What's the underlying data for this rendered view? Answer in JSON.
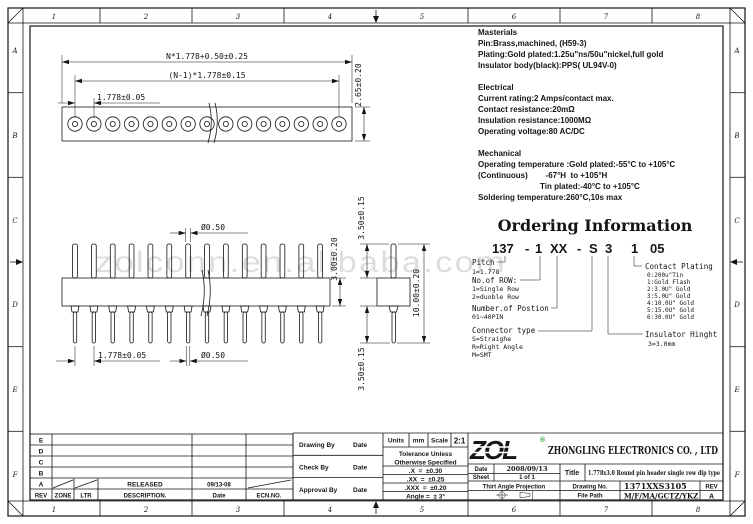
{
  "zones": {
    "cols": [
      "1",
      "2",
      "3",
      "4",
      "5",
      "6",
      "7",
      "8"
    ],
    "rows": [
      "A",
      "B",
      "C",
      "D",
      "E",
      "F"
    ]
  },
  "watermark": "zolconn.en.alibaba.com",
  "dims": {
    "top_overall": "N*1.778+0.50±0.25",
    "top_centers": "(N-1)*1.778±0.15",
    "top_pitch": "1.778±0.05",
    "top_height": "2.65±0.20",
    "pin_dia_top": "Ø0.50",
    "front_pitch": "1.778±0.05",
    "pin_dia_bottom": "Ø0.50",
    "body_height": "3.00±0.20",
    "side_top_pin": "3.50±0.15",
    "side_overall": "10.00±0.20",
    "side_bottom_pin": "3.50±0.15"
  },
  "specs": {
    "materials": {
      "title": "Masterials",
      "lines": [
        "Pin:Brass,machined, (H59-3)",
        "Plating:Gold plated:1.25u\"ns/50u\"nickel,full gold",
        "Insulator body(black):PPS( UL94V-0)"
      ]
    },
    "electrical": {
      "title": "Electrical",
      "lines": [
        "Current rating:2 Amps/contact max.",
        "Contact resistance:20mΩ",
        "Insulation resistance:1000MΩ",
        "Operating voltage:80 AC/DC"
      ]
    },
    "mechanical": {
      "title": "Mechanical",
      "lines": [
        "Operating temperature :Gold plated:-55°C to +105°C",
        "(Continuous)        -67°H  to +105°H",
        "Tin plated:-40°C to +105°C",
        "Soldering temperature:260°C,10s max"
      ]
    }
  },
  "ordering": {
    "title": "Ordering Information",
    "part_segments": [
      "137",
      "-",
      "1",
      "XX",
      "-",
      "S",
      "3",
      "1",
      "05"
    ],
    "pitch_label": "Pitch",
    "pitch_value": "1=1.778",
    "row_label": "No.of ROW:",
    "row_values": [
      "1=Single Row",
      "2=duoble Row"
    ],
    "position_label": "Number.of Postion",
    "position_value": "01~40PIN",
    "type_label": "Connector type",
    "type_values": [
      "S=Straighe",
      "R=Right Angle",
      "M=SMT"
    ],
    "plating_label": "Contact Plating",
    "plating_values": [
      "0:200u\"Tin",
      "1:Gold Flash",
      "2:3.0U\" Gold",
      "3:5.0U\" Gold",
      "4:10.0U\" Gold",
      "5:15.0U\" Gold",
      "6:30.0U\" Gold"
    ],
    "insulator_label": "Insulator Hinght",
    "insulator_value": "3=3.0mm"
  },
  "title_block": {
    "revision": {
      "headers": [
        "REV",
        "ZONE",
        "LTR",
        "DESCRIPTION.",
        "Date",
        "ECN.NO."
      ],
      "rows": [
        "E",
        "D",
        "C",
        "B",
        "A"
      ],
      "released": "RELEASED",
      "released_date": "09/13-08"
    },
    "sign": {
      "drawing_by": "Drawing By",
      "check_by": "Check By",
      "approval_by": "Approval By",
      "date": "Date"
    },
    "units": {
      "units_label": "Units",
      "units_value": "mm",
      "scale_label": "Scale",
      "scale_value": "2:1",
      "tol_line1": "Tolerance Unless",
      "tol_line2": "Otherwise Specified",
      "tols": [
        ".X  =  ±0.30",
        ".XX  =  ±0.25",
        ".XXX  =  ±0.20",
        "Angle =  ± 3°"
      ]
    },
    "company": {
      "logo": "ZOL",
      "reg": "®",
      "name": "ZHONGLING ELECTRONICS CO. , LTD"
    },
    "doc": {
      "date_label": "Date",
      "date_value": "2008/09/13",
      "sheet_label": "Sheet",
      "sheet_value": "1 of 1",
      "projection": "Thirt Angle Projection",
      "title_label": "Title",
      "title_value": "1.778x3.0 Round pin header single row dip type",
      "drawing_no_label": "Drawing No.",
      "drawing_no": "1371XXS3105",
      "rev_label": "REV",
      "rev_value": "A",
      "file_label": "File Path",
      "file_value": "M/F/MA/GCTZ/YKZ"
    }
  }
}
